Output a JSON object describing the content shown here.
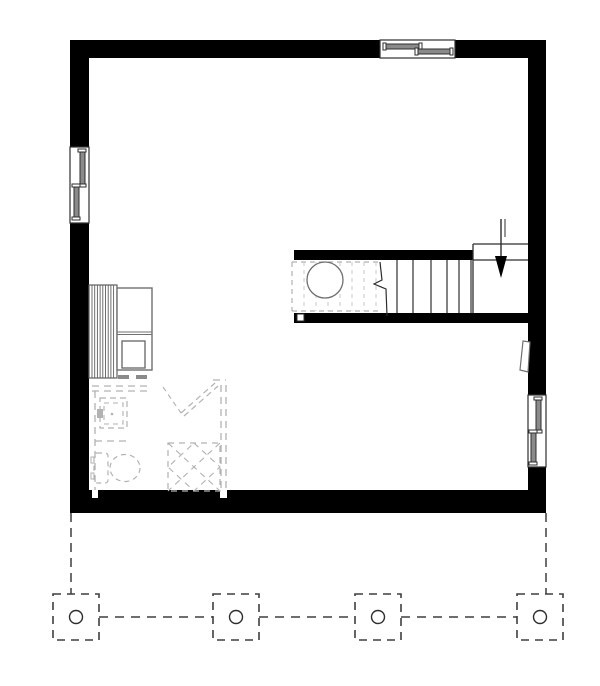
{
  "title": "basement-floor-plan",
  "canvas": {
    "width": 600,
    "height": 686,
    "background": "#ffffff"
  },
  "colors": {
    "wall": "#000000",
    "line": "#2e2e2e",
    "mech": "#6f6f6f",
    "hatch": "#5f5f5f",
    "dashLight": "#b2b2b2",
    "dashFaint": "#c9c9c9",
    "deckDash": "#3f3f3f",
    "sashFill": "#8a8a8a",
    "white": "#ffffff"
  },
  "floor_plan": {
    "shapes": [
      {
        "t": "line",
        "name": "deck-outline-left",
        "x1": 71,
        "y1": 513,
        "x2": 71,
        "y2": 594,
        "stroke": "deckDash",
        "sw": 1.5,
        "dash": "9,6"
      },
      {
        "t": "line",
        "name": "deck-outline-right",
        "x1": 546,
        "y1": 513,
        "x2": 546,
        "y2": 594,
        "stroke": "deckDash",
        "sw": 1.5,
        "dash": "9,6"
      },
      {
        "t": "line",
        "name": "deck-beam-segment-1",
        "x1": 99,
        "y1": 617,
        "x2": 213,
        "y2": 617,
        "stroke": "deckDash",
        "sw": 1.5,
        "dash": "9,7"
      },
      {
        "t": "line",
        "name": "deck-beam-segment-2",
        "x1": 259,
        "y1": 617,
        "x2": 355,
        "y2": 617,
        "stroke": "deckDash",
        "sw": 1.5,
        "dash": "9,7"
      },
      {
        "t": "line",
        "name": "deck-beam-segment-3",
        "x1": 401,
        "y1": 617,
        "x2": 517,
        "y2": 617,
        "stroke": "deckDash",
        "sw": 1.5,
        "dash": "9,7"
      },
      {
        "t": "rect",
        "name": "deck-pier-1",
        "x": 53,
        "y": 594,
        "w": 46,
        "h": 46,
        "fill": "white",
        "stroke": "deckDash",
        "sw": 1.6,
        "dash": "8,6"
      },
      {
        "t": "rect",
        "name": "deck-pier-2",
        "x": 213,
        "y": 594,
        "w": 46,
        "h": 46,
        "fill": "white",
        "stroke": "deckDash",
        "sw": 1.6,
        "dash": "8,6"
      },
      {
        "t": "rect",
        "name": "deck-pier-3",
        "x": 355,
        "y": 594,
        "w": 46,
        "h": 46,
        "fill": "white",
        "stroke": "deckDash",
        "sw": 1.6,
        "dash": "8,6"
      },
      {
        "t": "rect",
        "name": "deck-pier-4",
        "x": 517,
        "y": 594,
        "w": 46,
        "h": 46,
        "fill": "white",
        "stroke": "deckDash",
        "sw": 1.6,
        "dash": "8,6"
      },
      {
        "t": "circle",
        "name": "deck-pier-post-1",
        "cx": 76,
        "cy": 617,
        "r": 6.5,
        "fill": "white",
        "stroke": "line",
        "sw": 1.4
      },
      {
        "t": "circle",
        "name": "deck-pier-post-2",
        "cx": 236,
        "cy": 617,
        "r": 6.5,
        "fill": "white",
        "stroke": "line",
        "sw": 1.4
      },
      {
        "t": "circle",
        "name": "deck-pier-post-3",
        "cx": 378,
        "cy": 617,
        "r": 6.5,
        "fill": "white",
        "stroke": "line",
        "sw": 1.4
      },
      {
        "t": "circle",
        "name": "deck-pier-post-4",
        "cx": 540,
        "cy": 617,
        "r": 6.5,
        "fill": "white",
        "stroke": "line",
        "sw": 1.4
      },
      {
        "t": "rect",
        "name": "outer-wall-top",
        "x": 70,
        "y": 40,
        "w": 476,
        "h": 18,
        "fill": "wall"
      },
      {
        "t": "rect",
        "name": "outer-wall-left",
        "x": 70,
        "y": 40,
        "w": 19,
        "h": 450,
        "fill": "wall"
      },
      {
        "t": "rect",
        "name": "outer-wall-right",
        "x": 528,
        "y": 40,
        "w": 18,
        "h": 473,
        "fill": "wall"
      },
      {
        "t": "rect",
        "name": "outer-wall-bottom",
        "x": 70,
        "y": 490,
        "w": 476,
        "h": 23,
        "fill": "wall"
      },
      {
        "t": "rect",
        "name": "stair-wall-upper",
        "x": 294,
        "y": 250,
        "w": 179,
        "h": 10,
        "fill": "wall"
      },
      {
        "t": "rect",
        "name": "stair-wall-lower",
        "x": 294,
        "y": 313,
        "w": 234,
        "h": 10,
        "fill": "wall"
      },
      {
        "t": "rect",
        "name": "stair-wall-post",
        "x": 297,
        "y": 314,
        "w": 7,
        "h": 7,
        "fill": "white",
        "stroke": "line",
        "sw": 1
      },
      {
        "t": "rect",
        "name": "wall-notch-left",
        "x": 92,
        "y": 490,
        "w": 6,
        "h": 8,
        "fill": "white"
      },
      {
        "t": "rect",
        "name": "wall-notch-right",
        "x": 220,
        "y": 490,
        "w": 7,
        "h": 8,
        "fill": "white"
      },
      {
        "t": "rect",
        "name": "window-top-frame",
        "x": 380,
        "y": 40,
        "w": 75,
        "h": 18,
        "fill": "white",
        "stroke": "line",
        "sw": 1.2
      },
      {
        "t": "rect",
        "name": "window-top-sash-left",
        "x": 385,
        "y": 44,
        "w": 36,
        "h": 5,
        "fill": "sashFill",
        "stroke": "line",
        "sw": 1
      },
      {
        "t": "rect",
        "name": "window-top-sash-left-cap-a",
        "x": 383,
        "y": 43,
        "w": 3,
        "h": 7,
        "fill": "white",
        "stroke": "line",
        "sw": 1
      },
      {
        "t": "rect",
        "name": "window-top-sash-left-cap-b",
        "x": 419,
        "y": 43,
        "w": 3,
        "h": 7,
        "fill": "white",
        "stroke": "line",
        "sw": 1
      },
      {
        "t": "rect",
        "name": "window-top-sash-right",
        "x": 417,
        "y": 49,
        "w": 36,
        "h": 5,
        "fill": "sashFill",
        "stroke": "line",
        "sw": 1
      },
      {
        "t": "rect",
        "name": "window-top-sash-right-cap-a",
        "x": 415,
        "y": 48,
        "w": 3,
        "h": 7,
        "fill": "white",
        "stroke": "line",
        "sw": 1
      },
      {
        "t": "rect",
        "name": "window-top-sash-right-cap-b",
        "x": 450,
        "y": 48,
        "w": 3,
        "h": 7,
        "fill": "white",
        "stroke": "line",
        "sw": 1
      },
      {
        "t": "rect",
        "name": "window-left-frame",
        "x": 70,
        "y": 147,
        "w": 19,
        "h": 76,
        "fill": "white",
        "stroke": "line",
        "sw": 1.2
      },
      {
        "t": "rect",
        "name": "window-left-sash-top",
        "x": 80,
        "y": 151,
        "w": 5,
        "h": 34,
        "fill": "sashFill",
        "stroke": "line",
        "sw": 1
      },
      {
        "t": "rect",
        "name": "window-left-sash-top-cap-a",
        "x": 78,
        "y": 149,
        "w": 8,
        "h": 3,
        "fill": "white",
        "stroke": "line",
        "sw": 1
      },
      {
        "t": "rect",
        "name": "window-left-sash-top-cap-b",
        "x": 78,
        "y": 184,
        "w": 8,
        "h": 3,
        "fill": "white",
        "stroke": "line",
        "sw": 1
      },
      {
        "t": "rect",
        "name": "window-left-sash-bottom",
        "x": 74,
        "y": 186,
        "w": 5,
        "h": 33,
        "fill": "sashFill",
        "stroke": "line",
        "sw": 1
      },
      {
        "t": "rect",
        "name": "window-left-sash-bottom-cap-a",
        "x": 72,
        "y": 184,
        "w": 8,
        "h": 3,
        "fill": "white",
        "stroke": "line",
        "sw": 1
      },
      {
        "t": "rect",
        "name": "window-left-sash-bottom-cap-b",
        "x": 72,
        "y": 217,
        "w": 8,
        "h": 3,
        "fill": "white",
        "stroke": "line",
        "sw": 1
      },
      {
        "t": "rect",
        "name": "window-right-frame",
        "x": 528,
        "y": 395,
        "w": 18,
        "h": 72,
        "fill": "white",
        "stroke": "line",
        "sw": 1.2
      },
      {
        "t": "rect",
        "name": "window-right-sash-top",
        "x": 536,
        "y": 399,
        "w": 5,
        "h": 33,
        "fill": "sashFill",
        "stroke": "line",
        "sw": 1
      },
      {
        "t": "rect",
        "name": "window-right-sash-top-cap-a",
        "x": 534,
        "y": 397,
        "w": 8,
        "h": 3,
        "fill": "white",
        "stroke": "line",
        "sw": 1
      },
      {
        "t": "rect",
        "name": "window-right-sash-top-cap-b",
        "x": 534,
        "y": 430,
        "w": 8,
        "h": 3,
        "fill": "white",
        "stroke": "line",
        "sw": 1
      },
      {
        "t": "rect",
        "name": "window-right-sash-bottom",
        "x": 531,
        "y": 432,
        "w": 5,
        "h": 32,
        "fill": "sashFill",
        "stroke": "line",
        "sw": 1
      },
      {
        "t": "rect",
        "name": "window-right-sash-bottom-cap-a",
        "x": 529,
        "y": 430,
        "w": 8,
        "h": 3,
        "fill": "white",
        "stroke": "line",
        "sw": 1
      },
      {
        "t": "rect",
        "name": "window-right-sash-bottom-cap-b",
        "x": 529,
        "y": 462,
        "w": 8,
        "h": 3,
        "fill": "white",
        "stroke": "line",
        "sw": 1
      },
      {
        "t": "line",
        "name": "stair-landing-top-edge",
        "x1": 473,
        "y1": 244,
        "x2": 528,
        "y2": 244,
        "stroke": "line",
        "sw": 1.3
      },
      {
        "t": "line",
        "name": "stair-landing-left-edge",
        "x1": 473,
        "y1": 244,
        "x2": 473,
        "y2": 313,
        "stroke": "line",
        "sw": 1.3
      },
      {
        "t": "line",
        "name": "stair-landing-nosing-edge",
        "x1": 473,
        "y1": 260,
        "x2": 528,
        "y2": 260,
        "stroke": "line",
        "sw": 1.3
      },
      {
        "t": "vlines",
        "name": "stair-tread",
        "xs": [
          397,
          413,
          431,
          447,
          459,
          471
        ],
        "y1": 260,
        "y2": 313,
        "stroke": "line",
        "sw": 1.2
      },
      {
        "t": "polyline",
        "name": "stair-break-line",
        "pts": [
          [
            380,
            262
          ],
          [
            382,
            280
          ],
          [
            374,
            284
          ],
          [
            386,
            289
          ],
          [
            387,
            316
          ]
        ],
        "stroke": "line",
        "sw": 1.2
      },
      {
        "t": "line",
        "name": "stair-direction-arrow-shaft",
        "x1": 501,
        "y1": 219,
        "x2": 501,
        "y2": 258,
        "stroke": "line",
        "sw": 1.4
      },
      {
        "t": "line",
        "name": "stair-direction-arrow-shaft-b",
        "x1": 505,
        "y1": 219,
        "x2": 505,
        "y2": 237,
        "stroke": "line",
        "sw": 1
      },
      {
        "t": "polygon",
        "name": "stair-direction-arrow-head",
        "pts": [
          [
            495,
            256
          ],
          [
            507,
            256
          ],
          [
            501,
            278
          ]
        ],
        "fill": "wall"
      },
      {
        "t": "line",
        "name": "understair-dashed-top",
        "x1": 292,
        "y1": 262,
        "x2": 379,
        "y2": 262,
        "stroke": "dashLight",
        "sw": 1.2,
        "dash": "5,4"
      },
      {
        "t": "line",
        "name": "understair-dashed-bottom",
        "x1": 292,
        "y1": 311,
        "x2": 379,
        "y2": 311,
        "stroke": "dashLight",
        "sw": 1.2,
        "dash": "5,4"
      },
      {
        "t": "line",
        "name": "understair-dashed-left",
        "x1": 292,
        "y1": 262,
        "x2": 292,
        "y2": 311,
        "stroke": "dashLight",
        "sw": 1.2,
        "dash": "5,4"
      },
      {
        "t": "vlines",
        "name": "understair-joist-dash",
        "xs": [
          304,
          316,
          328,
          340,
          352,
          364,
          376
        ],
        "y1": 262,
        "y2": 311,
        "stroke": "dashFaint",
        "sw": 1,
        "dash": "4,4"
      },
      {
        "t": "circle",
        "name": "water-heater",
        "cx": 325,
        "cy": 280,
        "r": 18,
        "fill": "white",
        "stroke": "mech",
        "sw": 1.3
      },
      {
        "t": "rect",
        "name": "hvac-coil-unit",
        "x": 89,
        "y": 285,
        "w": 28,
        "h": 93,
        "fill": "white",
        "stroke": "hatch",
        "sw": 1.2
      },
      {
        "t": "vlines",
        "name": "hvac-coil-fin",
        "xs": [
          92,
          94.7,
          97.4,
          100.1,
          102.8,
          105.5,
          108.2,
          110.9,
          113.6
        ],
        "y1": 285,
        "y2": 378,
        "stroke": "hatch",
        "sw": 0.9
      },
      {
        "t": "rect",
        "name": "furnace-outer",
        "x": 117,
        "y": 288,
        "w": 35,
        "h": 82,
        "fill": "white",
        "stroke": "mech",
        "sw": 1.4
      },
      {
        "t": "line",
        "name": "furnace-divider-a",
        "x1": 117,
        "y1": 332,
        "x2": 152,
        "y2": 332,
        "stroke": "mech",
        "sw": 1
      },
      {
        "t": "line",
        "name": "furnace-divider-b",
        "x1": 117,
        "y1": 334.5,
        "x2": 152,
        "y2": 334.5,
        "stroke": "mech",
        "sw": 1
      },
      {
        "t": "rect",
        "name": "furnace-inner",
        "x": 122,
        "y": 341,
        "w": 23,
        "h": 27,
        "fill": "none",
        "stroke": "mech",
        "sw": 1.4
      },
      {
        "t": "rect",
        "name": "furnace-foot-a",
        "x": 118,
        "y": 375,
        "w": 11,
        "h": 4,
        "fill": "sashFill"
      },
      {
        "t": "rect",
        "name": "furnace-foot-b",
        "x": 136,
        "y": 375,
        "w": 11,
        "h": 4,
        "fill": "sashFill"
      },
      {
        "t": "line",
        "name": "future-wall-top-outer",
        "x1": 92,
        "y1": 386,
        "x2": 151,
        "y2": 386,
        "stroke": "dashLight",
        "sw": 1.3,
        "dash": "7,5"
      },
      {
        "t": "line",
        "name": "future-wall-top-inner",
        "x1": 92,
        "y1": 391,
        "x2": 151,
        "y2": 391,
        "stroke": "dashLight",
        "sw": 1.3,
        "dash": "7,5"
      },
      {
        "t": "line",
        "name": "future-wall-left",
        "x1": 95,
        "y1": 391,
        "x2": 95,
        "y2": 490,
        "stroke": "dashLight",
        "sw": 1.3,
        "dash": "7,5"
      },
      {
        "t": "line",
        "name": "future-wall-divider",
        "x1": 95,
        "y1": 441,
        "x2": 130,
        "y2": 441,
        "stroke": "dashLight",
        "sw": 1.3,
        "dash": "7,5"
      },
      {
        "t": "line",
        "name": "future-wall-right-outer",
        "x1": 221,
        "y1": 385,
        "x2": 221,
        "y2": 490,
        "stroke": "dashLight",
        "sw": 1.3,
        "dash": "7,5"
      },
      {
        "t": "line",
        "name": "future-wall-right-inner",
        "x1": 226,
        "y1": 385,
        "x2": 226,
        "y2": 490,
        "stroke": "dashLight",
        "sw": 1.3,
        "dash": "7,5"
      },
      {
        "t": "line",
        "name": "future-wall-corner-top",
        "x1": 213,
        "y1": 380,
        "x2": 226,
        "y2": 380,
        "stroke": "dashLight",
        "sw": 1.3,
        "dash": "7,5"
      },
      {
        "t": "line",
        "name": "future-door-swing",
        "x1": 163,
        "y1": 387,
        "x2": 181,
        "y2": 413,
        "stroke": "dashLight",
        "sw": 1.1,
        "dash": "5,4"
      },
      {
        "t": "line",
        "name": "future-door-leaf-a",
        "x1": 181,
        "y1": 413,
        "x2": 215,
        "y2": 383,
        "stroke": "dashLight",
        "sw": 1.2,
        "dash": "6,4"
      },
      {
        "t": "line",
        "name": "future-door-leaf-b",
        "x1": 184,
        "y1": 416,
        "x2": 218,
        "y2": 386,
        "stroke": "dashLight",
        "sw": 1.2,
        "dash": "6,4"
      },
      {
        "t": "rect",
        "name": "future-shower-outer",
        "x": 100,
        "y": 398,
        "w": 27,
        "h": 30,
        "fill": "none",
        "stroke": "dashLight",
        "sw": 1.2,
        "dash": "6,4"
      },
      {
        "t": "rect",
        "name": "future-shower-inner",
        "x": 104,
        "y": 403,
        "w": 19,
        "h": 21,
        "fill": "none",
        "stroke": "dashLight",
        "sw": 1.1,
        "dash": "5,4"
      },
      {
        "t": "rect",
        "name": "future-shower-valve",
        "x": 97,
        "y": 409,
        "w": 6,
        "h": 9,
        "fill": "dashLight"
      },
      {
        "t": "circle",
        "name": "future-shower-drain",
        "cx": 112,
        "cy": 414,
        "r": 1.3,
        "fill": "dashLight"
      },
      {
        "t": "rect",
        "name": "future-toilet-tank",
        "x": 94,
        "y": 453,
        "w": 14,
        "h": 30,
        "rx": 3,
        "fill": "none",
        "stroke": "dashLight",
        "sw": 1.2,
        "dash": "5,4"
      },
      {
        "t": "rect",
        "name": "future-toilet-tab-a",
        "x": 91,
        "y": 457,
        "w": 3,
        "h": 6,
        "fill": "none",
        "stroke": "dashLight",
        "sw": 1
      },
      {
        "t": "rect",
        "name": "future-toilet-tab-b",
        "x": 91,
        "y": 473,
        "w": 3,
        "h": 6,
        "fill": "none",
        "stroke": "dashLight",
        "sw": 1
      },
      {
        "t": "ellipse",
        "name": "future-toilet-bowl",
        "cx": 125,
        "cy": 468,
        "rx": 15,
        "ry": 13.5,
        "fill": "none",
        "stroke": "dashLight",
        "sw": 1.2,
        "dash": "5,4"
      },
      {
        "t": "rect",
        "name": "future-shower-stall-box",
        "x": 168,
        "y": 443,
        "w": 52,
        "h": 48,
        "fill": "none",
        "stroke": "dashLight",
        "sw": 1.2,
        "dash": "6,5"
      },
      {
        "t": "line",
        "name": "future-shower-stall-diag-a",
        "x1": 168,
        "y1": 443,
        "x2": 220,
        "y2": 491,
        "stroke": "dashLight",
        "sw": 1.1,
        "dash": "6,5"
      },
      {
        "t": "line",
        "name": "future-shower-stall-diag-b",
        "x1": 220,
        "y1": 443,
        "x2": 168,
        "y2": 491,
        "stroke": "dashLight",
        "sw": 1.1,
        "dash": "6,5"
      },
      {
        "t": "polygon",
        "name": "future-shower-stall-diamond",
        "pts": [
          [
            194,
            443
          ],
          [
            220,
            467
          ],
          [
            194,
            491
          ],
          [
            168,
            467
          ]
        ],
        "fill": "none",
        "stroke": "dashLight",
        "sw": 1.1,
        "dash": "6,5"
      },
      {
        "t": "polygon",
        "name": "electrical-panel",
        "pts": [
          [
            523,
            341
          ],
          [
            530,
            342
          ],
          [
            528,
            372
          ],
          [
            520,
            370
          ]
        ],
        "fill": "white",
        "stroke": "mech",
        "sw": 1.2
      }
    ]
  }
}
